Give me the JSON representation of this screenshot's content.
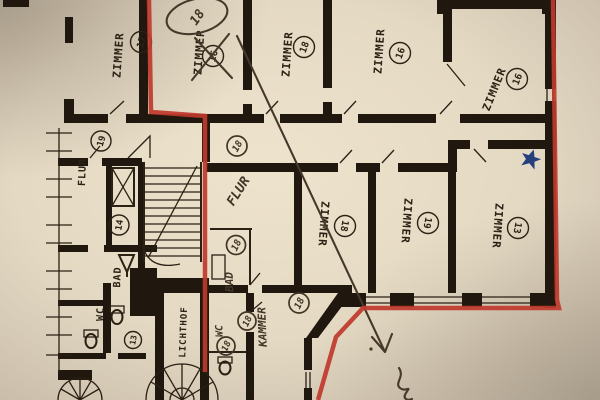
{
  "photo_meta": {
    "type": "photographed architectural floor plan",
    "language": "German"
  },
  "palette": {
    "paper": "#e9dfc9",
    "ink": "#20180e",
    "red_boundary": "#bf392c",
    "pencil": "#46382a",
    "blue_star": "#26407e"
  },
  "printed": {
    "zimmer17": {
      "label": "ZIMMER",
      "number": "17"
    },
    "zimmer_crossed": {
      "label": "ZIMMER",
      "number": "16",
      "status": "crossed-out"
    },
    "zimmer18_top": {
      "label": "ZIMMER",
      "number": "18"
    },
    "zimmer16_top": {
      "label": "ZIMMER",
      "number": "16"
    },
    "zimmer16_ne": {
      "label": "ZIMMER",
      "number": "16"
    },
    "zimmer18_mid": {
      "label": "ZIMMER",
      "number": "18"
    },
    "zimmer19_mid": {
      "label": "ZIMMER",
      "number": "19"
    },
    "zimmer13_e": {
      "label": "ZIMMER",
      "number": "13"
    },
    "flur": {
      "label": "FLUR",
      "number": "19"
    },
    "hall_number": {
      "number": "14"
    },
    "bad": {
      "label": "BAD"
    },
    "wc": {
      "label": "WC"
    },
    "wc_number": {
      "number": "13"
    },
    "lichthof": {
      "label": "LICHTHOF"
    }
  },
  "handwritten": {
    "top_room_renumber": {
      "number": "18"
    },
    "flur": {
      "label": "FLUR",
      "number": "18"
    },
    "bad": {
      "label": "BAD",
      "number": "18"
    },
    "wc": {
      "label": "WC",
      "number": "18"
    },
    "wc_second_number": {
      "number": "18"
    },
    "kammer": {
      "label": "KAMMER",
      "number": "18"
    }
  }
}
